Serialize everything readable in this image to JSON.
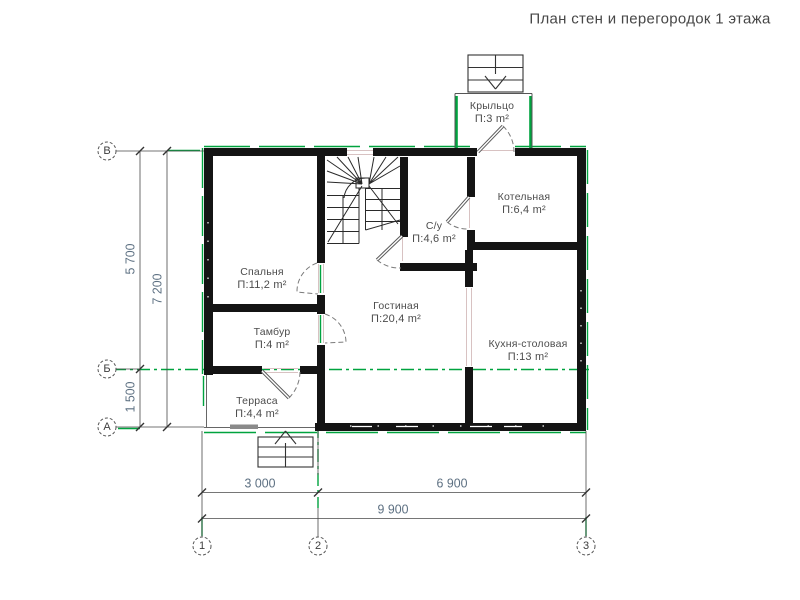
{
  "title": "План стен и перегородок 1 этажа",
  "rooms": [
    {
      "name": "Крыльцо",
      "area": "П:3 m²"
    },
    {
      "name": "Котельная",
      "area": "П:6,4 m²"
    },
    {
      "name": "С/у",
      "area": "П:4,6 m²"
    },
    {
      "name": "Спальня",
      "area": "П:11,2 m²"
    },
    {
      "name": "Гостиная",
      "area": "П:20,4 m²"
    },
    {
      "name": "Тамбур",
      "area": "П:4 m²"
    },
    {
      "name": "Кухня-столовая",
      "area": "П:13 m²"
    },
    {
      "name": "Терраса",
      "area": "П:4,4 m²"
    }
  ],
  "axes": {
    "left": [
      "В",
      "Б",
      "А"
    ],
    "bottom": [
      "1",
      "2",
      "3"
    ]
  },
  "dimensions": {
    "left_span_top": "5 700",
    "left_span_bottom": "1 500",
    "left_total": "7 200",
    "bottom_span_left": "3 000",
    "bottom_span_right": "6 900",
    "bottom_total": "9 900"
  },
  "colors": {
    "wall": "#141414",
    "axis_green": "#00a33f",
    "dim_text": "#5d7082",
    "label_text": "#4c4c4c"
  }
}
